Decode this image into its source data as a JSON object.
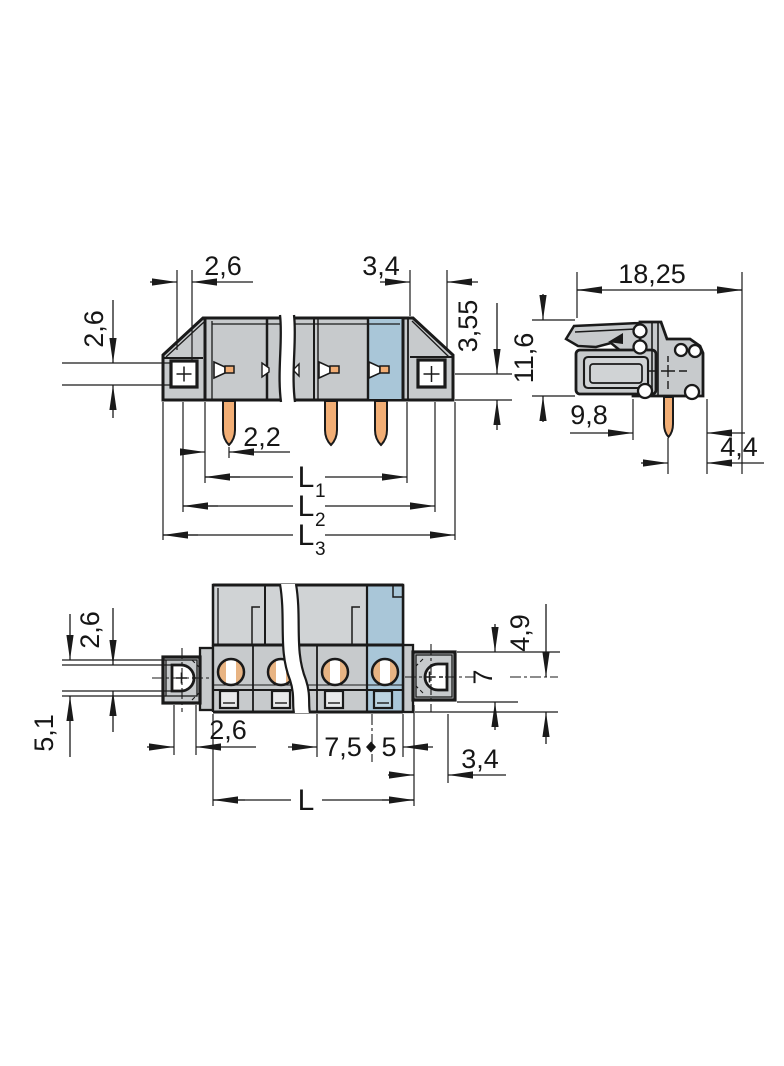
{
  "drawing": {
    "type": "technical-dimension-drawing",
    "views": {
      "front": {
        "dims": {
          "flange_offset_top": "2,6",
          "pole_width_top": "3,4",
          "hole_height_left": "2,6",
          "hole_to_bottom_right": "3,55",
          "pin_offset": "2,2",
          "l1_base": "L",
          "l1_sub": "1",
          "l2_base": "L",
          "l2_sub": "2",
          "l3_base": "L",
          "l3_sub": "3"
        }
      },
      "side": {
        "dims": {
          "total_depth": "18,25",
          "height": "11,6",
          "pin_from_front": "9,8",
          "pin_to_back": "4,4"
        }
      },
      "bottom": {
        "dims": {
          "hole_height_left": "2,6",
          "flange_height_left": "5,1",
          "hole_width_bottom": "2,6",
          "pitch_a": "7,5",
          "pitch_b": "5",
          "length_base": "L",
          "flange_width_right": "3,4",
          "center_offset_right": "4,9",
          "flange_depth_right": "7"
        }
      }
    },
    "colors": {
      "body_gray": "#c7cacc",
      "light_gray": "#d0d3d5",
      "accent_blue": "#a9c6d8",
      "pin_orange": "#f2ae75",
      "line": "#1a1a1a"
    }
  }
}
